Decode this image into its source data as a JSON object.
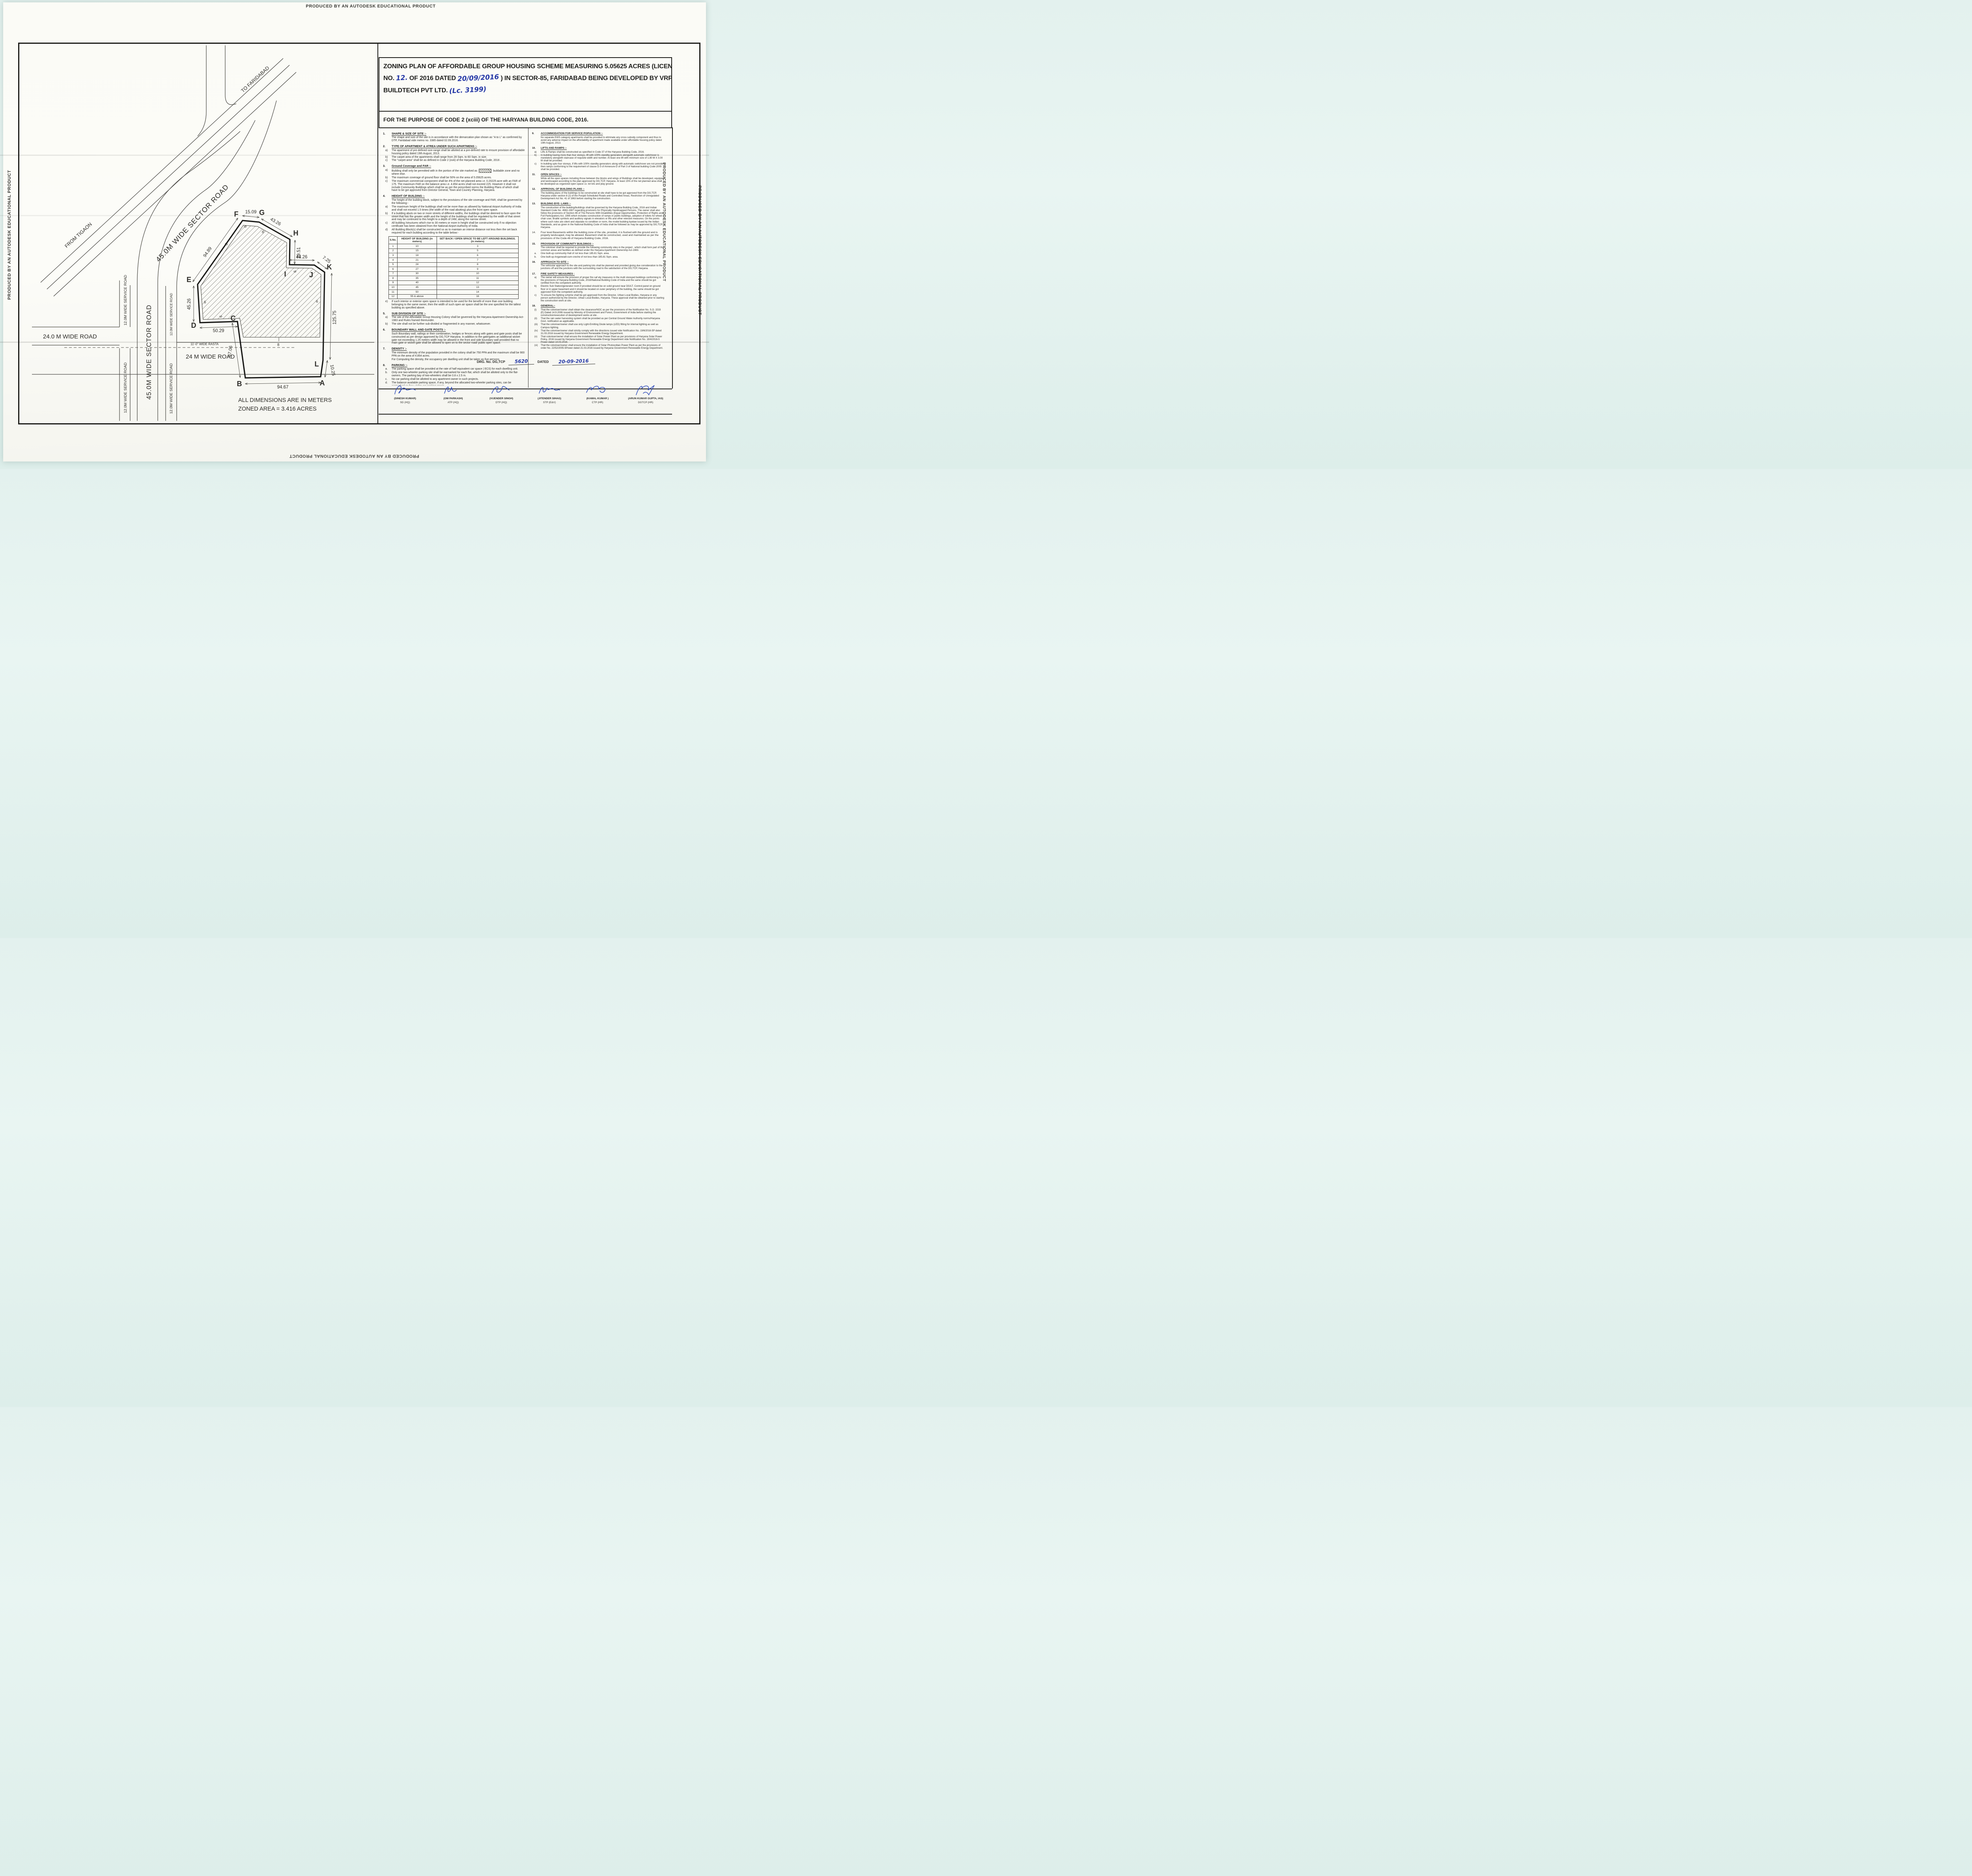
{
  "edge_text": "PRODUCED BY AN AUTODESK EDUCATIONAL PRODUCT",
  "title": {
    "line1": "ZONING PLAN OF AFFORDABLE GROUP HOUSING SCHEME MEASURING  5.05625 ACRES  (LICENCE",
    "line2_pre": "NO.",
    "line2_hand1": "12.",
    "line2_mid": "OF 2016 DATED",
    "line2_hand2": "20/09/2016",
    "line2_post": ") IN SECTOR-85, FARIDABAD  BEING DEVELOPED BY VRP",
    "line3_pre": "BUILDTECH PVT LTD.",
    "line3_hand": "(Lc. 3199)"
  },
  "purpose": "FOR THE PURPOSE OF CODE 2 (xciii) OF THE HARYANA BUILDING CODE, 2016.",
  "left_sections": [
    {
      "num": "1.",
      "heading": "SHAPE & SIZE OF SITE :-",
      "paras": [
        "The shape and size of the site is in accordance with the demarcation plan shown as \"A to L\" as confirmed by DTP, Faridabad vide memo no. 3385 dated 02.09.2016."
      ]
    },
    {
      "num": "2.",
      "heading": "TYPE OF APARTMENT & ATREA UNDER SUCH APARTMENS :-",
      "items": [
        {
          "l": "a)",
          "t": "The apartment of pre-defined size-range shall be allotted at a pre-defined rate to ensure provision of affordable housing policy dated 19th August, 2013."
        },
        {
          "l": "b)",
          "t": "The carpet area of the apartments shall  range from 28 Sqm. to 60 Sqm. in size."
        },
        {
          "l": "c)",
          "t": "The \"carpet area\" shall be as defined in Code 2 (xviii) of the Haryana Building Code, 2016 ."
        }
      ]
    },
    {
      "num": "3.",
      "heading": "Ground Coverage and FAR :-",
      "items": [
        {
          "l": "a)",
          "t": "Building shall only be permitted with in the portion of the site marked as",
          "sw": true,
          "t2": "buildable  zone and no where else."
        },
        {
          "l": "b)",
          "t": "The maximum coverage of ground floor shall be 50%  on the area of 5.05625 acres."
        },
        {
          "l": "c)",
          "t": "The maximum commercial component shall be 4% of the net planned area i.e. 0.20225 acre with an FAR of 175. The maximum FAR on the balance area i.e. 4.854 acres shall not exceed 225. However it shall not include Community Buildings which shall be as per the prescribed norms the Building Plans of which shall have to be got approved from Director General, Town and Country Planning, Haryana."
        }
      ]
    },
    {
      "num": "4.",
      "heading": "HEIGHT OF BUILDING :-",
      "paras": [
        "The height of the building block, subject to the provisions of the site coverage and FAR, shall be governed by the following:-"
      ],
      "items": [
        {
          "l": "a)",
          "t": "The maximum height of the buildings shall not be more than as allowed by National Airport Authority of India and shall not exceed 1.5 times (the width of the road abutting) plus the front  open space."
        },
        {
          "l": "b)",
          "t": "If a building abuts on two or more streets of different widths, the buildings shall be deemed to face  upon the street that has the greater width and the height of the buildings shall be regulated by the width of that street and may be continued to this height to a depth of 24M, along the narrow street."
        },
        {
          "l": "c)",
          "t": "All building /structures which rise to 30 meters or more in height shall be constructed only if no objection certificate has been obtained from the National Airport Authority of India."
        },
        {
          "l": "d)",
          "t": "All Building Block(s) shall be constructed so as to maintain an interse distance not less then the set back required for each building according to the table below:-"
        }
      ],
      "table": true,
      "items_after": [
        {
          "l": "e)",
          "t": "If such interior or exterior open space is intended to be used for the benefit of more than one building belonging to the same owner, then the width of such open air space  shall be the one specified for the tallest building as specified above."
        }
      ]
    },
    {
      "num": "5.",
      "heading": "SUB DIVISION OF SITE :-",
      "items": [
        {
          "l": "a)",
          "t": "The site of the Affordable Group Housing Colony shall be governed by the Haryana Apartment Ownership Act-1983 and Rules framed thereunder."
        },
        {
          "l": "b)",
          "t": "The site shall not be further sub-divided or fragmented in any  manner, whatsoever."
        }
      ]
    },
    {
      "num": "6.",
      "heading": "BOUNDARY WALL AND GATE POSTS :-",
      "paras": [
        "Such Boundary wall, railings or their combination, hedges or fences along with gates and gate posts shall be constructed as per design approved by DG,TCP Haryana. In addition to the gate/gates an additional wicket gate not exceeding 1.25 meters width may be allowed in the front and side boundary wall provided that no main gate or wicket gate shall be allowed to open on to the sector road/ public open space."
      ]
    },
    {
      "num": "7.",
      "heading": "DENSITY :-",
      "paras": [
        "The minimum density of the population provided in the colony shall be 750 PPA and the maximum shall be 900 PPA on the area of  4.854 acres.",
        "For Computing the density, the occupancy per dwelling unit shall be taken as five persons."
      ]
    },
    {
      "num": "8.",
      "heading": "PARKING :-",
      "items": [
        {
          "l": "a.",
          "t": "The parking space shall be provided at the rate of half equivalent car space ( ECS) for each dwelling unit."
        },
        {
          "l": "b.",
          "t": "Only one two-wheeler parking site shall be earmarked for each flat, which shall be allotted only to the flat-owners. The parking bay of two-wheelers shall be 0.8 x 2.5 m."
        },
        {
          "l": "c.",
          "t": "No car parking shall be allotted to any apartment owner in such projects."
        },
        {
          "l": "d.",
          "t": "The balance available parking space, if any, beyond the allocated two-wheeler parking sites, can be earmarked as free-visitor-car-parking space"
        },
        {
          "l": "e.",
          "t": "The area for parking per car shall be as under :-"
        },
        {
          "l": "(i)",
          "t": "Basement   32 Sqm.",
          "ind": true
        },
        {
          "l": "(ii)",
          "t": "Stilts         28 Sqm.",
          "ind": true
        },
        {
          "l": "(iii)",
          "t": "Open         23 Sqm.",
          "ind": true
        }
      ]
    }
  ],
  "right_sections": [
    {
      "num": "9.",
      "heading": "ACCOMMODATION FOR SERVICE POPULATION :-",
      "paras": [
        "No separate EWS category apartments shall be provided to eliminate any cross subsidy component and thus to avoid any adverse impact on the affordability of apartment made available under affordable housing policy dated 19th August, 2013."
      ]
    },
    {
      "num": "10.",
      "heading": "LIFTS AND RAMPS :-",
      "items": [
        {
          "l": "a)",
          "t": "Lifts & Ramps shall be constructed as specified in Code 37 of the Haryana Building Code, 2016."
        },
        {
          "l": "b)",
          "t": "In building having more than four storeys, lift with 100% standby generators alongwith automatic switchover is mandatory alongwith staircase of requisite width and number. At least one lift  with minimum size of 1.80 M X 3.00 M shall be provided."
        },
        {
          "l": "c)",
          "t": "In building upto four storeys, if lifts with 100% standby generators  along with automatic switchover are not provided then ramps conforming to the requirement of clause D-3 of Annexure-D of Part 3 of National building Code-2005 shall be provided."
        }
      ]
    },
    {
      "num": "11.",
      "heading": "OPEN SPACES :-",
      "paras": [
        "While all the open spaces including those between the blocks and wings of Buildings shall be developed, equipped and landscaped according to the plan approved by DG,TCP, Haryana. At least 15% of the net planned area shall be developed as organized open space i.e. tot lots and play ground."
      ]
    },
    {
      "num": "12.",
      "heading": "APPROVAL OF BUILDING PLANS :-",
      "paras": [
        "The building plans of the buildings to be constructed at site shall have to be got approved from the DG,TCP, Haryana under section 8 (2) of the Punjab Scheduled Roads and Controlled Areas, Restriction of Unregulated Development Act No. 41 of 1963 before starting the construction."
      ]
    },
    {
      "num": "13.",
      "heading": "BUILDING BYE- LAWS :-",
      "paras": [
        "The construction of the building/buildings shall be governed by the Haryana Building Code, 2016 and Indian Standard Code No. 4963-1987 regarding provisions for Physically Handicapped Persons. The owner shall also follow the provisions of Section 46 of The Persons With Disabilities (Equal Opportunities, Protection of Rights and Full Participation) Act, 1995 which includes construction of ramps in public buildings, adoption of toilets for wheel chair user, Braille symbols and auditory signals in elevators or lifts and other relevant measures. On  the points where such rules are silent and stipulate no condition or norm, the model building byelaw issued by the Indian Standards, and as given in the National Building Code of India shall be followed as may be approved by DG,TCP, Haryana."
      ]
    },
    {
      "num": "14.",
      "heading": "",
      "text": "Four level Basements within the building zone of the site, provided, it is flushed with the ground and is properly landscaped, may be allowed. Basement shall be constructed, used and maintained as per the provisions of the Code-46 of Haryana Building Code, 2016."
    },
    {
      "num": "15.",
      "heading": "PROVISION OF COMMUNITY BUILDINGS :-",
      "paras": [
        "The coloniser shall be required to provide the following community sites in the project , which shall form part of the common areas and facilities as defined under the Haryana Apartment Ownership Act-1983."
      ],
      "items": [
        {
          "l": "a.",
          "t": "One built-up community Hall of not less than 185.81 Sqm. area."
        },
        {
          "l": "b.",
          "t": "One built-up Anganwadi-cum-creche of not less than 185.81 Sqm. area."
        }
      ]
    },
    {
      "num": "16.",
      "heading": "APPROACH TO SITE :-",
      "paras": [
        "The vehicular approach to the site and parking lots shall be planned and provided giving due consideration to the junctions off and the junctions with the surrounding road to the satisfaction of the DG,TCP, Haryana."
      ]
    },
    {
      "num": "17.",
      "heading": "FIRE SAFETY MEASURES :",
      "items": [
        {
          "l": "a)",
          "t": "The owner will ensure the provision of proper fire saf ety measures in the multi storeyed buildings conforming to the provisions of Haryana Building Code, 2016/National Building Code of India and the same should be got certified from the competent authority."
        },
        {
          "l": "b)",
          "t": "Electric Sub Station/generator room if provided should be on solid ground near DG/LT. Control panel on ground floor or in upper basement and it should be located on outer periphery of the building, the same should be got approved from the competent authority."
        },
        {
          "l": "c)",
          "t": "To ensure fire fighting scheme shall be got approved from the Director, Urban Local Bodies, Haryana or any person authorized by the Director, Urban Local Bodies, Haryana. These approval shall be obtained prior to starting the construction work at site."
        }
      ]
    },
    {
      "num": "18.",
      "heading": "GENERAL:-",
      "items": [
        {
          "l": "(i)",
          "t": "That the coloniser/owner shall obtain the clearance/NOC as per the provisions of the Notification No. S.O. 1533 (E) Dated 14.9.2006  issued by Ministry of Environment and Forest, Government of India  before starting the construction/execution of development works at site ."
        },
        {
          "l": "(ii)",
          "t": "That the rain water harvesting system shall be provided as per Central Ground Water Authority norms/Haryana Govt. notification as applicable."
        },
        {
          "l": "(iii)",
          "t": "That the coloniser/owner shall use only Light-Emitting Diode lamps (LED) fitting for internal lighting as well as Campus lighting."
        },
        {
          "l": "(iv)",
          "t": "That the coloniser/owner shall strictly comply with the directions issued vide Notification No. 19/6/2016-5P dated 31.03.2016 issued by Haryana Government Renewable Energy Department."
        },
        {
          "l": "(v)",
          "t": "That coloniser/owner shall ensure the installation of Solar Power Plant as per provisions of Haryana Solar Power Policy, 2016 issued by Haryana Government Renewable Energy Department vide Notification No. 19/4/2016-5 Power dated 14.03.2016."
        },
        {
          "l": "(vi)",
          "t": "That the coloniser/owner shall ensure the installation of Solar Photovoltaic Power Plant as per the provisions of order No. 22/52/2005-5Power dated 21.03.2016 issued by Haryana Government Renewable Energy Department."
        }
      ]
    }
  ],
  "table": {
    "headers": [
      "S.No.",
      "HEIGHT OF BUILDING (in meters)",
      "SET BACK / OPEN SPACE TO BE LEFT AROUND BUILDINGS. (in meters)"
    ],
    "rows": [
      [
        "1",
        "10",
        "3"
      ],
      [
        "2",
        "15",
        "5"
      ],
      [
        "3",
        "18",
        "6"
      ],
      [
        "4",
        "21",
        "7"
      ],
      [
        "5",
        "24",
        "8"
      ],
      [
        "6",
        "27",
        "9"
      ],
      [
        "7",
        "30",
        "10"
      ],
      [
        "8",
        "35",
        "11"
      ],
      [
        "9",
        "40",
        "12"
      ],
      [
        "10",
        "45",
        "13"
      ],
      [
        "11",
        "50",
        "14"
      ],
      [
        "12",
        "55 & above",
        "16"
      ]
    ]
  },
  "drg": {
    "label1": "DRG. No. DG,TCP",
    "value1": "5620",
    "label2": "DATED",
    "value2": "20-09-2016"
  },
  "signatures": [
    {
      "name": "(DINESH KUMAR)",
      "role": "SD (HQ)"
    },
    {
      "name": "(OM PARKASH)",
      "role": "ATP (HQ)"
    },
    {
      "name": "(VIJENDER SINGH)",
      "role": "DTP (HQ)"
    },
    {
      "name": "(JITENDER SIHAG)",
      "role": "STP (E&V)"
    },
    {
      "name": "(KAMAL KUMAR )",
      "role": "CTP (HR)"
    },
    {
      "name": "(ARUN KUMAR GUPTA, IAS)",
      "role": "DGTCP (HR)"
    }
  ],
  "plan": {
    "roads": {
      "to_faridabad": "TO FARIDABAD",
      "from_tigaon": "FROM TIGAON",
      "sector": "45.0M WIDE SECTOR ROAD",
      "service": "12.0M WIDE SERVICE ROAD",
      "road24_left": "24.0 M WIDE ROAD",
      "road24_bottom": "24 M WIDE ROAD",
      "rasta": "11'-0\" WIDE RASTA"
    },
    "dims": {
      "fg": "15.09",
      "gh": "43.26",
      "hi": "29.51",
      "ij": "44.26",
      "jk": "7.25",
      "ef": "94.89",
      "de": "45.26",
      "dc": "50.29",
      "cb": "67.06",
      "ba": "94.67",
      "la": "10.25",
      "kl": "125.75",
      "setback": "6",
      "setback8": "8"
    },
    "vertices": {
      "a": "A",
      "b": "B",
      "c": "C",
      "d": "D",
      "e": "E",
      "f": "F",
      "g": "G",
      "h": "H",
      "i": "I",
      "j": "J",
      "k": "K",
      "l": "L"
    },
    "notes": {
      "line1": "ALL DIMENSIONS ARE IN METERS",
      "line2": "ZONED AREA = 3.416 ACRES"
    }
  },
  "colors": {
    "handwriting_blue": "#2437a6",
    "paper": "#fbfbf6",
    "ink": "#1b1b18",
    "signature_blue": "#2744b8"
  }
}
